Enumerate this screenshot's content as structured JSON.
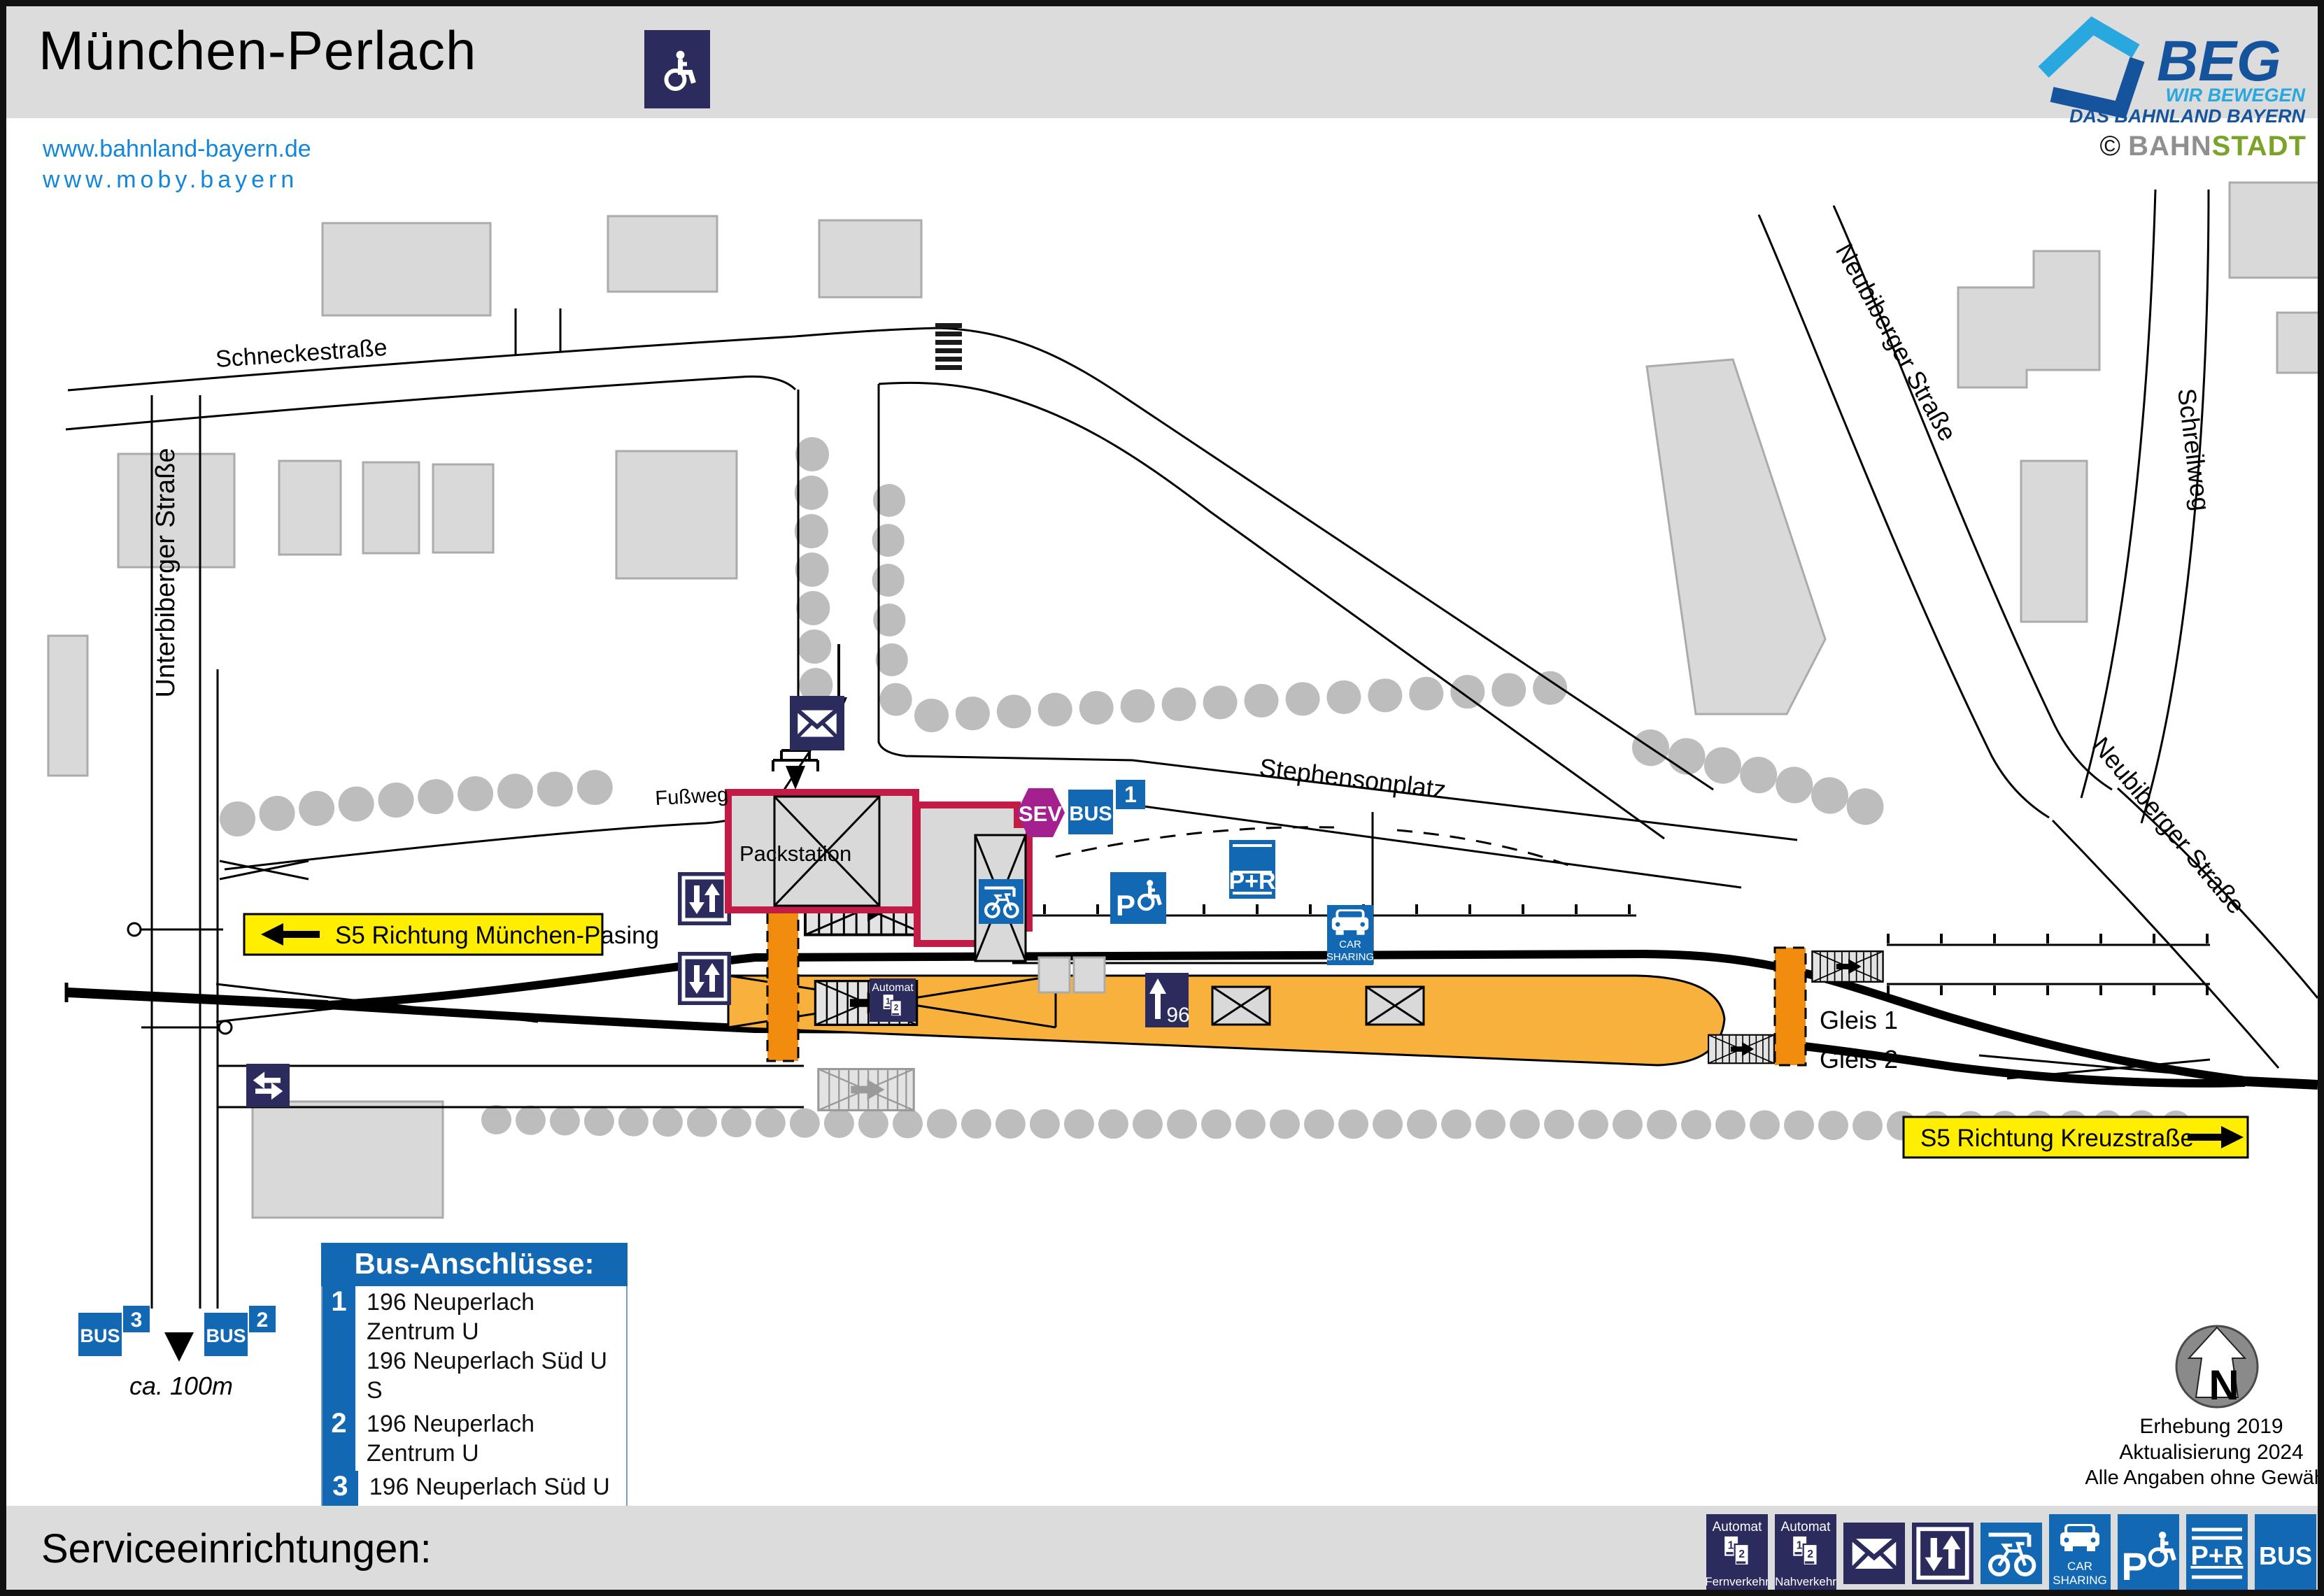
{
  "header": {
    "title": "München-Perlach",
    "links": {
      "l1": "www.bahnland-bayern.de",
      "l2": "www.moby.bayern"
    },
    "beg": {
      "name": "BEG",
      "tagline_top": "WIR BEWEGEN",
      "tagline_bottom": "DAS BAHNLAND BAYERN"
    },
    "credit": {
      "sign": "©",
      "part1": "BAHN",
      "part2": "STADT"
    }
  },
  "map": {
    "streets": {
      "schneckestrasse": "Schneckestraße",
      "unterbiberger": "Unterbiberger Straße",
      "neubiberger_nord": "Neubiberger Straße",
      "neubiberger_ost": "Neubiberger Straße",
      "schreilweg": "Schreilweg",
      "stephensonplatz": "Stephensonplatz",
      "fussweg": "Fußweg"
    },
    "labels": {
      "packstation": "Packstation",
      "gleis1": "Gleis 1",
      "gleis2": "Gleis 2",
      "automat": "Automat",
      "platform_sign_number": "96",
      "ca_100m": "ca. 100m"
    },
    "directions": {
      "left": "S5 Richtung München-Pasing",
      "right": "S5 Richtung Kreuzstraße"
    },
    "badges": {
      "sev": "SEV",
      "bus": "BUS",
      "stop1": "1",
      "stop2": "2",
      "stop3": "3",
      "pr": "P+R",
      "car1": "CAR",
      "car2": "SHARING",
      "p": "P"
    },
    "north": {
      "letter": "N",
      "line1": "Erhebung 2019",
      "line2": "Aktualisierung 2024",
      "line3": "Alle Angaben ohne Gewähr!"
    }
  },
  "bus_box": {
    "title": "Bus-Anschlüsse:",
    "rows": [
      {
        "stop": "1",
        "lines": [
          "196 Neuperlach Zentrum U",
          "196 Neuperlach Süd U S"
        ]
      },
      {
        "stop": "2",
        "lines": [
          "196 Neuperlach Zentrum U"
        ]
      },
      {
        "stop": "3",
        "lines": [
          "196 Neuperlach Süd U S"
        ]
      }
    ]
  },
  "footer": {
    "label": "Serviceeinrichtungen:",
    "icons": [
      {
        "name": "ticket-machine-long-distance",
        "caption_top": "Automat",
        "caption_bottom": "Fernverkehr"
      },
      {
        "name": "ticket-machine-local",
        "caption_top": "Automat",
        "caption_bottom": "Nahverkehr"
      },
      {
        "name": "mailbox"
      },
      {
        "name": "elevator"
      },
      {
        "name": "bike-parking"
      },
      {
        "name": "car-sharing",
        "cap1": "CAR",
        "cap2": "SHARING"
      },
      {
        "name": "accessible-parking",
        "letter": "P"
      },
      {
        "name": "park-and-ride",
        "label": "P+R"
      },
      {
        "name": "bus",
        "label": "BUS"
      }
    ]
  },
  "colors": {
    "navy": "#2b2b5e",
    "traffic_blue": "#1268b3",
    "sev_purple": "#a5208f",
    "packstation_red": "#c21b46",
    "platform_orange": "#f9b13d",
    "access_orange": "#f28c0f",
    "signal_yellow": "#ffee00",
    "band_gray": "#dcdcdc",
    "building_gray": "#d9d9d9",
    "tree_gray": "#bdbdbd",
    "link_blue": "#1486d8",
    "beg_light": "#29a7df",
    "beg_dark": "#15549c",
    "stadt_green": "#7aa327"
  }
}
